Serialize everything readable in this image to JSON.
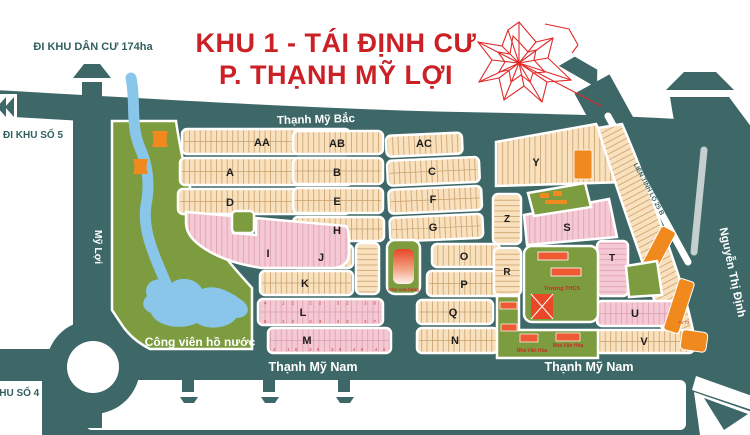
{
  "title": {
    "line1": "KHU 1 - TÁI ĐỊNH CƯ",
    "line2": "P. THẠNH MỸ LỢI"
  },
  "roads": {
    "north": "Thạnh Mỹ Bắc",
    "south_left": "Thạnh Mỹ Nam",
    "south_right": "Thạnh Mỹ Nam",
    "west": "Mỹ Lợi",
    "east": "Nguyễn Thị Định",
    "highway": "LIÊN TỈNH LỘ 25 B",
    "exit_top": "ĐI KHU DÂN CƯ 174ha",
    "exit_left_upper": "ĐI KHU SỐ 5",
    "exit_left_lower": "KHU SỐ 4"
  },
  "park": {
    "name": "Công viên hồ nước"
  },
  "facilities": {
    "market": "Chợ cửa hàng",
    "school": "Trường THCS",
    "culture_house_1": "Nhà Văn Hóa",
    "culture_house_2": "Nhà Văn Hóa"
  },
  "blocks": {
    "AA": "AA",
    "AB": "AB",
    "AC": "AC",
    "A": "A",
    "B": "B",
    "C": "C",
    "D": "D",
    "E": "E",
    "F": "F",
    "G": "G",
    "H": "H",
    "I": "I",
    "J": "J",
    "K": "K",
    "L": "L",
    "M": "M",
    "N": "N",
    "O": "O",
    "P": "P",
    "Q": "Q",
    "R": "R",
    "S": "S",
    "T": "T",
    "U": "U",
    "V": "V",
    "Y": "Y",
    "Z": "Z"
  },
  "lot_numbers": {
    "L_top": "4    12    22    32  36",
    "L_bottom": "5    13    23    33  37",
    "M_bottom": "2    10    20    30    40  44",
    "U_right": "75 73"
  },
  "colors": {
    "road": "#3e6767",
    "block_peach": "#f9e1be",
    "block_pink": "#f4c9d3",
    "park_green": "#7c9c3f",
    "water_blue": "#8ac6e9",
    "orange": "#f08a1e",
    "building_red": "#ee5a33",
    "title_red": "#cb2026",
    "compass_red": "#e02a2a"
  }
}
